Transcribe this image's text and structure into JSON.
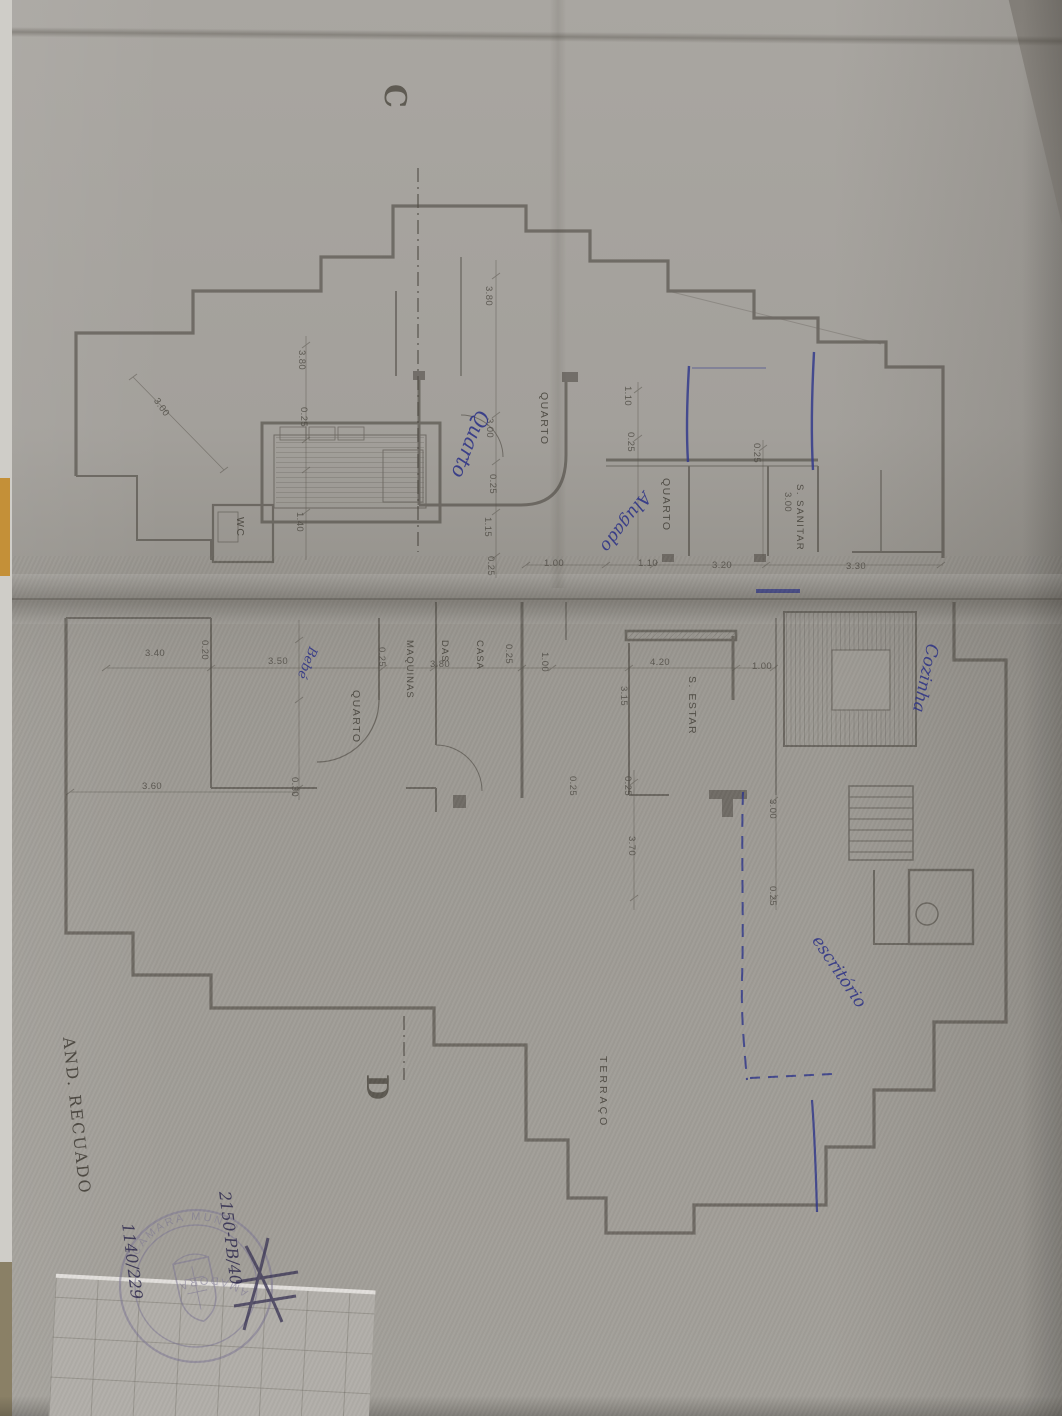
{
  "section_markers": {
    "top": "C",
    "bottom": "D"
  },
  "rooms": [
    {
      "label": "QUARTO"
    },
    {
      "label": "QUARTO"
    },
    {
      "label": "S. SANITAR"
    },
    {
      "label": "WC"
    },
    {
      "label": "QUARTO"
    },
    {
      "lines": [
        "CASA",
        "DAS",
        "MAQUINAS"
      ]
    },
    {
      "label": "S. ESTAR"
    },
    {
      "label": "TERRAÇO"
    }
  ],
  "dimensions": [
    {
      "v": "3.00"
    },
    {
      "v": "3.80"
    },
    {
      "v": "0.25"
    },
    {
      "v": "1.40"
    },
    {
      "v": "3.80"
    },
    {
      "v": "3.00"
    },
    {
      "v": "0.25"
    },
    {
      "v": "1.15"
    },
    {
      "v": "0.25"
    },
    {
      "v": "1.00"
    },
    {
      "v": "1.10"
    },
    {
      "v": "3.20"
    },
    {
      "v": "3.30"
    },
    {
      "v": "1.10"
    },
    {
      "v": "0.25"
    },
    {
      "v": "0.25"
    },
    {
      "v": "3.00"
    },
    {
      "v": "3.40"
    },
    {
      "v": "0.20"
    },
    {
      "v": "3.50"
    },
    {
      "v": "0.25"
    },
    {
      "v": "3.80"
    },
    {
      "v": "0.25"
    },
    {
      "v": "1.00"
    },
    {
      "v": "4.20"
    },
    {
      "v": "3.15"
    },
    {
      "v": "1.00"
    },
    {
      "v": "0.25"
    },
    {
      "v": "0.25"
    },
    {
      "v": "3.70"
    },
    {
      "v": "3.00"
    },
    {
      "v": "0.25"
    },
    {
      "v": "3.60"
    },
    {
      "v": "0.30"
    }
  ],
  "handwritten": {
    "note_quarto": "Quarto",
    "note_alugado": "Alugado",
    "note_cozinha": "Cozinha",
    "note_bebe": "Bebé",
    "note_escritorio": "escritório",
    "note_and_recuado": "AND. RECUADO",
    "ref_number_1": "2150-PB/40",
    "ref_number_2": "1140/229"
  },
  "stamp": {
    "ring_top": "CÂMARA MUNICIPAL",
    "ring_bottom": "AMADORA"
  },
  "colors": {
    "ink_blue": "#2c3286",
    "pencil_gray": "#3e3a32",
    "stamp_purple": "#7e7894",
    "paper_gray": "#a09d97",
    "folder_orange": "#c49038"
  }
}
